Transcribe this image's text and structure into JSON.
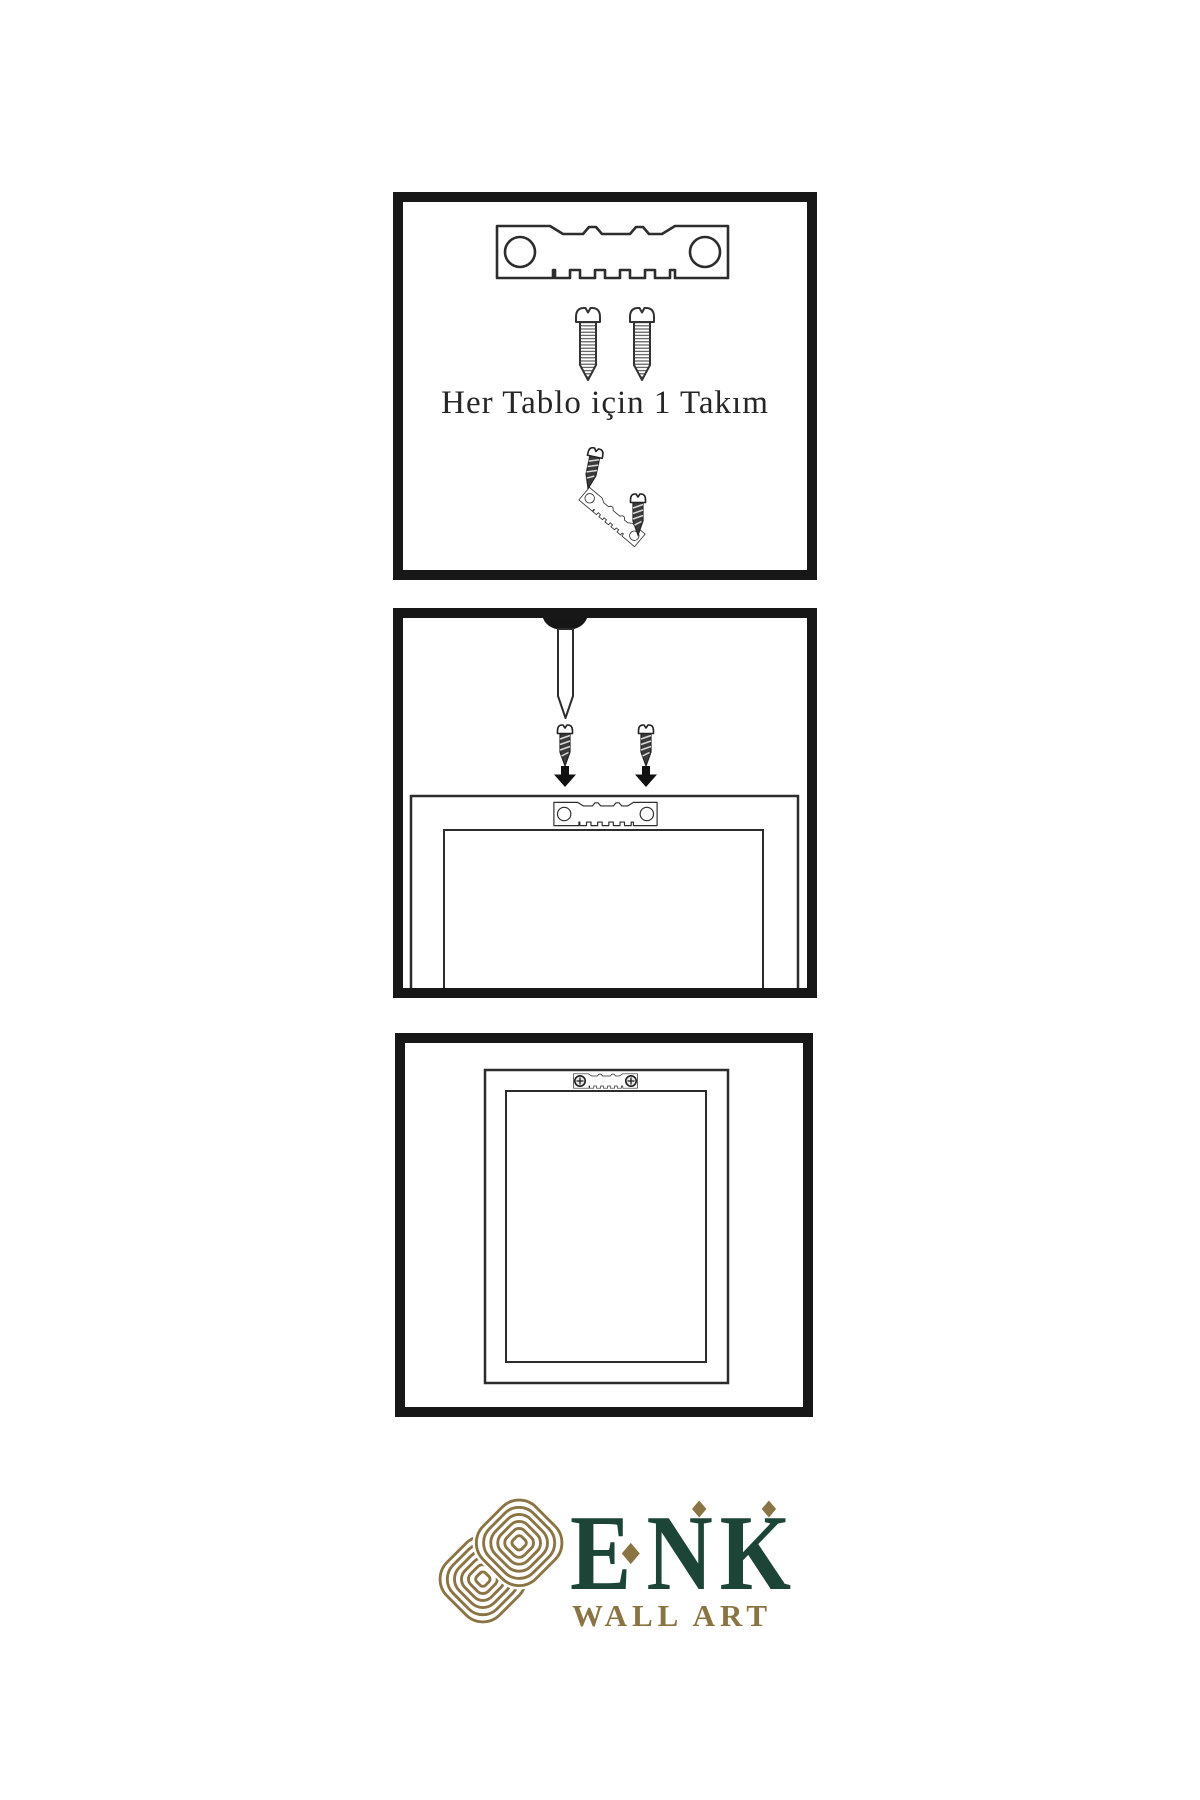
{
  "page": {
    "width": 1200,
    "height": 1800,
    "background": "#ffffff",
    "type": "wall-art mounting instruction sheet"
  },
  "steps": {
    "panel1": {
      "caption": "Her Tablo için 1 Takım",
      "items": [
        "sawtooth-hanger",
        "screw",
        "screw",
        "small-screw",
        "tilted-sawtooth-hanger",
        "small-screw"
      ]
    },
    "panel2": {
      "items": [
        "wall-nail",
        "small-screw",
        "small-screw",
        "arrow-down",
        "arrow-down",
        "frame-back",
        "sawtooth-hanger"
      ]
    },
    "panel3": {
      "items": [
        "frame-back",
        "mounted-sawtooth-hanger-with-screws"
      ]
    }
  },
  "brand": {
    "name": "ENK",
    "name_parts": {
      "first": "E",
      "rest": "NK"
    },
    "tagline": "WALL ART",
    "name_color": "#1c4437",
    "accent_gold": "#8a7444",
    "icon": "interlocked-knot"
  },
  "palette": {
    "panel_border": "#171717",
    "line_color": "#2d2d2d",
    "dark_metal": "#3b3b3b",
    "caption_text": "#262626",
    "background": "#ffffff"
  }
}
